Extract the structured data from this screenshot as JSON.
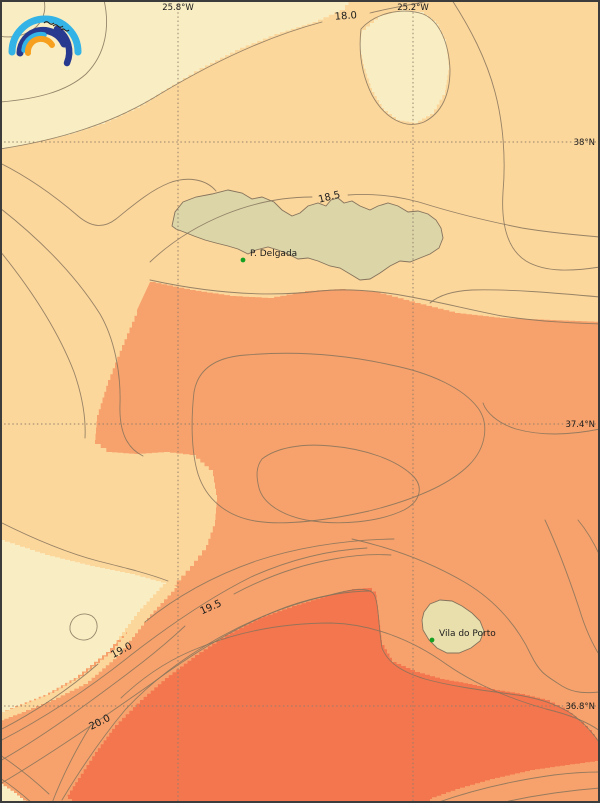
{
  "map": {
    "description_labels": {
      "place_1": "P. Delgada",
      "place_2": "Vila do Porto"
    }
  },
  "grid": {
    "meridians": [
      "25.8°W",
      "25.2°W"
    ],
    "parallels": [
      "38°N",
      "37.4°N",
      "36.8°N"
    ]
  },
  "isotherm_labels": [
    "18.0",
    "18.5",
    "19.0",
    "19.5",
    "20.0"
  ],
  "places": [
    {
      "name": "P. Delgada"
    },
    {
      "name": "Vila do Porto"
    }
  ],
  "colors": {
    "cream": "#f9eec3",
    "band": "#fcd79c",
    "salmon": "#f7a26c",
    "red": "#f4764e",
    "island": "#dcd5a8",
    "island2": "#e9dfad",
    "line": "#85735c",
    "grid": "#8f7d6a",
    "text": "#1c1c1c",
    "marker": "#16a022",
    "frame": "#3c3c3c",
    "logo_blue": "#33b3e6",
    "logo_navy": "#283a8f",
    "logo_orange": "#f7a01f"
  },
  "chart_data": {
    "type": "contour",
    "title": "Sea surface temperature contour map (°C), Azores region",
    "isotherms_c": [
      18.0,
      18.5,
      19.0,
      19.5,
      20.0
    ],
    "fill_bands": [
      {
        "range": "< 18.0 °C",
        "color": "#f9eec3"
      },
      {
        "range": "18.0 – 19.0 °C",
        "color": "#fcd79c"
      },
      {
        "range": "19.0 – 20.0 °C",
        "color": "#f7a26c"
      },
      {
        "range": "> 20.0 °C",
        "color": "#f4764e"
      }
    ],
    "lon_gridlines_w": [
      25.8,
      25.2
    ],
    "lat_gridlines_n": [
      38.0,
      37.4,
      36.8
    ],
    "approx_lon_range_w": [
      26.25,
      24.72
    ],
    "approx_lat_range_n": [
      36.59,
      38.3
    ],
    "temperature_trend": "cooler (cream) in the northwest, warmer (red) in the south",
    "grid": "dotted",
    "legend_position": "none"
  }
}
